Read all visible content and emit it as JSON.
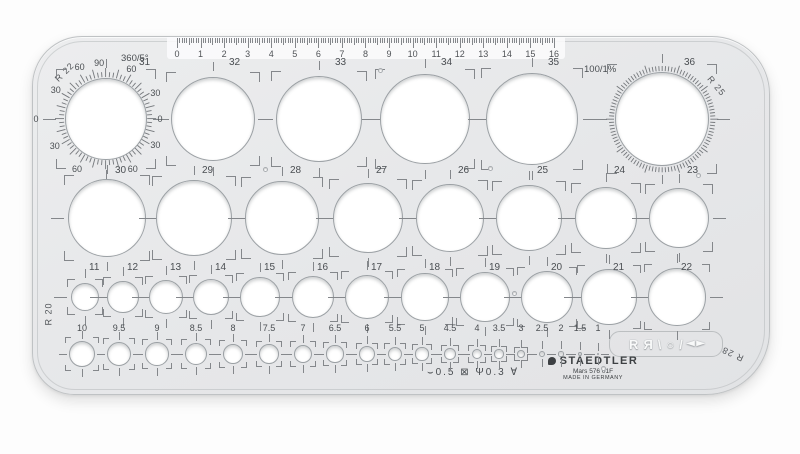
{
  "corner_radii": {
    "top_left": "R 22",
    "top_right": "R 25",
    "bottom_left": "R 20",
    "bottom_right": "R 28"
  },
  "protractors": {
    "degree": {
      "title": "360/5°",
      "divisions": 72,
      "labels": [
        [
          -97,
          "90",
          56
        ],
        [
          -117,
          "60",
          58
        ],
        [
          -150,
          "30",
          58
        ],
        [
          180,
          "0",
          70
        ],
        [
          152,
          "30",
          58
        ],
        [
          120,
          "60",
          58
        ],
        [
          62,
          "60",
          57
        ],
        [
          28,
          "30",
          56
        ],
        [
          0,
          "0",
          54
        ],
        [
          -28,
          "30",
          56
        ],
        [
          -63,
          "60",
          56
        ]
      ]
    },
    "percent": {
      "title": "100/1%",
      "divisions": 100
    }
  },
  "ruler": {
    "numbers": [
      "0",
      "1",
      "2",
      "3",
      "4",
      "5",
      "6",
      "7",
      "8",
      "9",
      "10",
      "11",
      "12",
      "13",
      "14",
      "15",
      "16"
    ]
  },
  "rows": [
    {
      "id": "large",
      "kind": "squared",
      "cy": 118,
      "label_y": 57,
      "circles": [
        {
          "n": "31",
          "mm": 31,
          "cx": 105,
          "protractor": "degree"
        },
        {
          "n": "32",
          "mm": 32,
          "cx": 212
        },
        {
          "n": "33",
          "mm": 33,
          "cx": 318
        },
        {
          "n": "34",
          "mm": 34,
          "cx": 424
        },
        {
          "n": "35",
          "mm": 35,
          "cx": 531
        },
        {
          "n": "36",
          "mm": 36,
          "cx": 661,
          "protractor": "percent"
        }
      ]
    },
    {
      "id": "medium",
      "kind": "squared",
      "cy": 217,
      "label_y": 165,
      "circles": [
        {
          "n": "30",
          "mm": 30,
          "cx": 106
        },
        {
          "n": "29",
          "mm": 29,
          "cx": 193
        },
        {
          "n": "28",
          "mm": 28,
          "cx": 281
        },
        {
          "n": "27",
          "mm": 27,
          "cx": 367
        },
        {
          "n": "26",
          "mm": 26,
          "cx": 449
        },
        {
          "n": "25",
          "mm": 25,
          "cx": 528
        },
        {
          "n": "24",
          "mm": 24,
          "cx": 605
        },
        {
          "n": "23",
          "mm": 23,
          "cx": 678
        }
      ]
    },
    {
      "id": "small",
      "kind": "squared",
      "cy": 296,
      "label_y": 262,
      "circles": [
        {
          "n": "11",
          "mm": 11,
          "cx": 84
        },
        {
          "n": "12",
          "mm": 12,
          "cx": 122
        },
        {
          "n": "13",
          "mm": 13,
          "cx": 165
        },
        {
          "n": "14",
          "mm": 14,
          "cx": 210
        },
        {
          "n": "15",
          "mm": 15,
          "cx": 259
        },
        {
          "n": "16",
          "mm": 16,
          "cx": 312
        },
        {
          "n": "17",
          "mm": 17,
          "cx": 366
        },
        {
          "n": "18",
          "mm": 18,
          "cx": 424
        },
        {
          "n": "19",
          "mm": 19,
          "cx": 484
        },
        {
          "n": "20",
          "mm": 20,
          "cx": 546
        },
        {
          "n": "21",
          "mm": 21,
          "cx": 608
        },
        {
          "n": "22",
          "mm": 22,
          "cx": 676
        }
      ]
    },
    {
      "id": "tiny",
      "kind": "cross",
      "cy": 353,
      "label_y": 322,
      "circles": [
        {
          "n": "10",
          "mm": 10,
          "cx": 81
        },
        {
          "n": "9.5",
          "mm": 9.5,
          "cx": 118
        },
        {
          "n": "9",
          "mm": 9,
          "cx": 156
        },
        {
          "n": "8.5",
          "mm": 8.5,
          "cx": 195
        },
        {
          "n": "8",
          "mm": 8,
          "cx": 232
        },
        {
          "n": "7.5",
          "mm": 7.5,
          "cx": 268
        },
        {
          "n": "7",
          "mm": 7,
          "cx": 302
        },
        {
          "n": "6.5",
          "mm": 6.5,
          "cx": 334
        },
        {
          "n": "6",
          "mm": 6,
          "cx": 366
        },
        {
          "n": "5.5",
          "mm": 5.5,
          "cx": 394
        },
        {
          "n": "5",
          "mm": 5,
          "cx": 421
        },
        {
          "n": "4.5",
          "mm": 4.5,
          "cx": 449
        },
        {
          "n": "4",
          "mm": 4,
          "cx": 476
        },
        {
          "n": "3.5",
          "mm": 3.5,
          "cx": 498
        },
        {
          "n": "3",
          "mm": 3,
          "cx": 520
        },
        {
          "n": "2.5",
          "mm": 2.5,
          "cx": 541
        },
        {
          "n": "2",
          "mm": 2,
          "cx": 560
        },
        {
          "n": "1.5",
          "mm": 1.5,
          "cx": 579
        },
        {
          "n": "1",
          "mm": 1,
          "cx": 597
        }
      ]
    }
  ],
  "brand": {
    "name": "STAEDTLER",
    "model": "Mars 576 01F",
    "origin": "MADE IN GERMANY"
  },
  "pen_width_marks": "⌣0.5 ⊠ Ψ0.3 ∀",
  "cutouts": [
    "R",
    "Я",
    "\\",
    "○",
    "/",
    "◂",
    "▸"
  ],
  "holes": [
    [
      345,
      31
    ],
    [
      230,
      130
    ],
    [
      455,
      129
    ],
    [
      663,
      136
    ],
    [
      479,
      254
    ],
    [
      568,
      329
    ]
  ]
}
